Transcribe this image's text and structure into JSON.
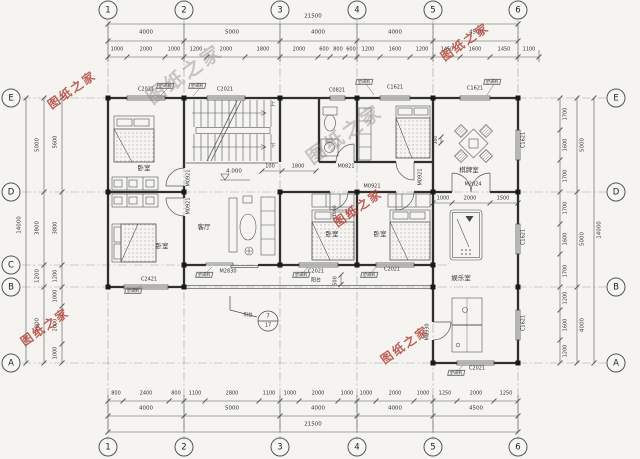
{
  "meta": {
    "drawing_type": "residential floor plan",
    "language": "zh-CN"
  },
  "colors": {
    "paper": "#f5f4f1",
    "ink": "#333333",
    "wall": "#2f2f2f",
    "watermark_red": "#b03e34",
    "watermark_gray": "#7d7d7d"
  },
  "watermark_text": "图纸之家",
  "grid": {
    "top": [
      {
        "t": "1",
        "x": 108
      },
      {
        "t": "2",
        "x": 184
      },
      {
        "t": "3",
        "x": 280
      },
      {
        "t": "4",
        "x": 357
      },
      {
        "t": "5",
        "x": 433
      },
      {
        "t": "6",
        "x": 518
      }
    ],
    "bottom": [
      {
        "t": "1",
        "x": 108
      },
      {
        "t": "2",
        "x": 184
      },
      {
        "t": "3",
        "x": 280
      },
      {
        "t": "4",
        "x": 357
      },
      {
        "t": "5",
        "x": 433
      },
      {
        "t": "6",
        "x": 518
      }
    ],
    "left": [
      {
        "t": "E",
        "y": 98
      },
      {
        "t": "D",
        "y": 192
      },
      {
        "t": "C",
        "y": 265
      },
      {
        "t": "B",
        "y": 287
      },
      {
        "t": "A",
        "y": 363
      }
    ],
    "right": [
      {
        "t": "E",
        "y": 98
      },
      {
        "t": "D",
        "y": 192
      },
      {
        "t": "B",
        "y": 287
      },
      {
        "t": "A",
        "y": 363
      }
    ]
  },
  "annotations": {
    "dim_labels": [
      {
        "t": "21500",
        "x": 313,
        "y": 17,
        "s": 5.5
      },
      {
        "t": "4000",
        "x": 146,
        "y": 33,
        "s": 5.5
      },
      {
        "t": "5000",
        "x": 232,
        "y": 33,
        "s": 5.5
      },
      {
        "t": "4000",
        "x": 318,
        "y": 33,
        "s": 5.5
      },
      {
        "t": "4000",
        "x": 395,
        "y": 33,
        "s": 5.5
      },
      {
        "t": "4500",
        "x": 476,
        "y": 33,
        "s": 5.5
      },
      {
        "t": "1000",
        "x": 117,
        "y": 50
      },
      {
        "t": "2000",
        "x": 146,
        "y": 50
      },
      {
        "t": "1000",
        "x": 174,
        "y": 50
      },
      {
        "t": "1200",
        "x": 196,
        "y": 50
      },
      {
        "t": "2000",
        "x": 226,
        "y": 50
      },
      {
        "t": "1800",
        "x": 263,
        "y": 50
      },
      {
        "t": "2000",
        "x": 299,
        "y": 50
      },
      {
        "t": "600",
        "x": 324,
        "y": 50
      },
      {
        "t": "800",
        "x": 338,
        "y": 50
      },
      {
        "t": "600",
        "x": 351,
        "y": 50
      },
      {
        "t": "1200",
        "x": 368,
        "y": 50
      },
      {
        "t": "1600",
        "x": 395,
        "y": 50
      },
      {
        "t": "1200",
        "x": 422,
        "y": 50
      },
      {
        "t": "1450",
        "x": 447,
        "y": 50
      },
      {
        "t": "1600",
        "x": 475,
        "y": 50
      },
      {
        "t": "1450",
        "x": 504,
        "y": 50
      },
      {
        "t": "1100",
        "x": 529,
        "y": 50
      },
      {
        "t": "800",
        "x": 116,
        "y": 394
      },
      {
        "t": "2400",
        "x": 146,
        "y": 394
      },
      {
        "t": "800",
        "x": 176,
        "y": 394
      },
      {
        "t": "1100",
        "x": 195,
        "y": 394
      },
      {
        "t": "2800",
        "x": 232,
        "y": 394
      },
      {
        "t": "1100",
        "x": 269,
        "y": 394
      },
      {
        "t": "1000",
        "x": 290,
        "y": 394
      },
      {
        "t": "2000",
        "x": 318,
        "y": 394
      },
      {
        "t": "1000",
        "x": 347,
        "y": 394
      },
      {
        "t": "1000",
        "x": 366,
        "y": 394
      },
      {
        "t": "2000",
        "x": 395,
        "y": 394
      },
      {
        "t": "1000",
        "x": 423,
        "y": 394
      },
      {
        "t": "1250",
        "x": 445,
        "y": 394
      },
      {
        "t": "2000",
        "x": 476,
        "y": 394
      },
      {
        "t": "1250",
        "x": 506,
        "y": 394
      },
      {
        "t": "4000",
        "x": 146,
        "y": 409,
        "s": 5.5
      },
      {
        "t": "5000",
        "x": 232,
        "y": 409,
        "s": 5.5
      },
      {
        "t": "4000",
        "x": 318,
        "y": 409,
        "s": 5.5
      },
      {
        "t": "4000",
        "x": 395,
        "y": 409,
        "s": 5.5
      },
      {
        "t": "4500",
        "x": 476,
        "y": 409,
        "s": 5.5
      },
      {
        "t": "21500",
        "x": 313,
        "y": 425,
        "s": 5.5
      },
      {
        "t": "5600",
        "x": 56,
        "y": 142,
        "r": -90
      },
      {
        "t": "3800",
        "x": 56,
        "y": 228,
        "r": -90
      },
      {
        "t": "1200",
        "x": 56,
        "y": 276,
        "r": -90
      },
      {
        "t": "1000",
        "x": 56,
        "y": 296,
        "r": -90
      },
      {
        "t": "2000",
        "x": 56,
        "y": 325,
        "r": -90
      },
      {
        "t": "1000",
        "x": 56,
        "y": 353,
        "r": -90
      },
      {
        "t": "5000",
        "x": 38,
        "y": 145,
        "r": -90,
        "s": 5.5
      },
      {
        "t": "3800",
        "x": 38,
        "y": 228,
        "r": -90,
        "s": 5.5
      },
      {
        "t": "1200",
        "x": 38,
        "y": 276,
        "r": -90,
        "s": 5.5
      },
      {
        "t": "4000",
        "x": 38,
        "y": 325,
        "r": -90,
        "s": 5.5
      },
      {
        "t": "14000",
        "x": 20,
        "y": 225,
        "r": -90,
        "s": 5.5
      },
      {
        "t": "1700",
        "x": 566,
        "y": 114,
        "r": -90
      },
      {
        "t": "1600",
        "x": 566,
        "y": 145,
        "r": -90
      },
      {
        "t": "1700",
        "x": 566,
        "y": 176,
        "r": -90
      },
      {
        "t": "1700",
        "x": 566,
        "y": 208,
        "r": -90
      },
      {
        "t": "1600",
        "x": 566,
        "y": 239,
        "r": -90
      },
      {
        "t": "1700",
        "x": 566,
        "y": 271,
        "r": -90
      },
      {
        "t": "1200",
        "x": 566,
        "y": 298,
        "r": -90
      },
      {
        "t": "1600",
        "x": 566,
        "y": 325,
        "r": -90
      },
      {
        "t": "1200",
        "x": 566,
        "y": 351,
        "r": -90
      },
      {
        "t": "5000",
        "x": 583,
        "y": 145,
        "r": -90,
        "s": 5.5
      },
      {
        "t": "5000",
        "x": 583,
        "y": 239,
        "r": -90,
        "s": 5.5
      },
      {
        "t": "4000",
        "x": 583,
        "y": 325,
        "r": -90,
        "s": 5.5
      },
      {
        "t": "14000",
        "x": 600,
        "y": 230,
        "r": -90,
        "s": 5.5
      },
      {
        "t": "100",
        "x": 270,
        "y": 167
      },
      {
        "t": "1800",
        "x": 298,
        "y": 167
      },
      {
        "t": "1000",
        "x": 443,
        "y": 199
      },
      {
        "t": "2000",
        "x": 470,
        "y": 199
      },
      {
        "t": "1500",
        "x": 503,
        "y": 199
      },
      {
        "t": "500",
        "x": 336,
        "y": 281,
        "r": -90
      },
      {
        "t": "300",
        "x": 437,
        "y": 140,
        "r": -90,
        "s": 4.5
      },
      {
        "t": "1000",
        "x": 336,
        "y": 211,
        "r": -90,
        "s": 4.5
      }
    ],
    "window_labels": [
      {
        "t": "C2021",
        "x": 146,
        "y": 90
      },
      {
        "t": "C2021",
        "x": 225,
        "y": 90
      },
      {
        "t": "C0821",
        "x": 337,
        "y": 91
      },
      {
        "t": "C1621",
        "x": 395,
        "y": 88
      },
      {
        "t": "C1621",
        "x": 475,
        "y": 89
      },
      {
        "t": "C2421",
        "x": 149,
        "y": 280
      },
      {
        "t": "C2021",
        "x": 316,
        "y": 272
      },
      {
        "t": "C2021",
        "x": 392,
        "y": 270
      },
      {
        "t": "C2021",
        "x": 477,
        "y": 369
      },
      {
        "t": "C1621",
        "x": 524,
        "y": 140,
        "r": -90
      },
      {
        "t": "C1621",
        "x": 524,
        "y": 237,
        "r": -90
      },
      {
        "t": "C1621",
        "x": 524,
        "y": 323,
        "r": -90
      }
    ],
    "door_labels": [
      {
        "t": "M2830",
        "x": 228,
        "y": 272
      },
      {
        "t": "M2024",
        "x": 473,
        "y": 185
      },
      {
        "t": "M0821",
        "x": 346,
        "y": 167
      },
      {
        "t": "M0921",
        "x": 372,
        "y": 187
      },
      {
        "t": "M0921",
        "x": 189,
        "y": 178,
        "r": -90
      },
      {
        "t": "M0921",
        "x": 189,
        "y": 206,
        "r": -90
      },
      {
        "t": "M0921",
        "x": 421,
        "y": 177,
        "r": -90
      },
      {
        "t": "M0930",
        "x": 428,
        "y": 332,
        "r": -90
      }
    ],
    "room_labels": [
      {
        "t": "卧室",
        "x": 144,
        "y": 168
      },
      {
        "t": "卧室",
        "x": 162,
        "y": 246
      },
      {
        "t": "卧室",
        "x": 332,
        "y": 234
      },
      {
        "t": "卧室",
        "x": 380,
        "y": 234
      },
      {
        "t": "客厅",
        "x": 204,
        "y": 227
      },
      {
        "t": "棋牌室",
        "x": 469,
        "y": 170
      },
      {
        "t": "娱乐室",
        "x": 461,
        "y": 278
      },
      {
        "t": "阳台",
        "x": 316,
        "y": 281,
        "s": 5
      },
      {
        "t": "阳台",
        "x": 248,
        "y": 316,
        "s": 4.5
      }
    ],
    "ac_tags": [
      {
        "t": "空调机",
        "x": 165,
        "y": 86
      },
      {
        "t": "空调机",
        "x": 197,
        "y": 86
      },
      {
        "t": "空调机",
        "x": 364,
        "y": 82
      },
      {
        "t": "空调机",
        "x": 492,
        "y": 82
      },
      {
        "t": "空调机",
        "x": 133,
        "y": 291
      },
      {
        "t": "空调机",
        "x": 204,
        "y": 275
      },
      {
        "t": "空调机",
        "x": 301,
        "y": 275
      },
      {
        "t": "空调机",
        "x": 369,
        "y": 275
      },
      {
        "t": "空调机",
        "x": 456,
        "y": 373
      }
    ],
    "stair_labels": [
      {
        "t": "上",
        "x": 273,
        "y": 105
      },
      {
        "t": "下",
        "x": 273,
        "y": 147
      }
    ],
    "level_labels": [
      {
        "t": "4.000",
        "x": 234,
        "y": 172
      }
    ],
    "detail_labels": [
      {
        "t": "7",
        "x": 268,
        "y": 317
      },
      {
        "t": "17",
        "x": 268,
        "y": 326,
        "s": 5
      }
    ],
    "watermarks": [
      {
        "t": "图纸之家",
        "x": 72,
        "y": 90,
        "c": "wm-red"
      },
      {
        "t": "图纸之家",
        "x": 465,
        "y": 42,
        "c": "wm-red"
      },
      {
        "t": "图纸之家",
        "x": 358,
        "y": 208,
        "c": "wm-red"
      },
      {
        "t": "图纸之家",
        "x": 45,
        "y": 327,
        "c": "wm-red"
      },
      {
        "t": "图纸之家",
        "x": 405,
        "y": 345,
        "c": "wm-red"
      },
      {
        "t": "图纸之家",
        "x": 185,
        "y": 75,
        "s": 19,
        "c": "wm-gray"
      },
      {
        "t": "图纸之家",
        "x": 345,
        "y": 135,
        "s": 19,
        "c": "wm-gray"
      }
    ]
  }
}
